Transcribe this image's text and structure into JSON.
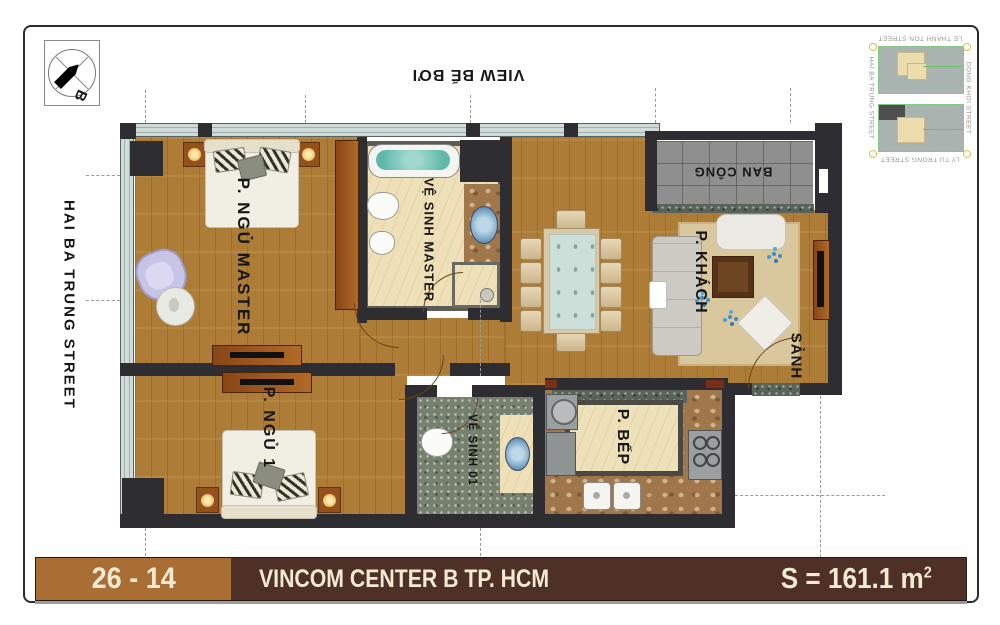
{
  "footer": {
    "unit": "26 - 14",
    "project": "VINCOM CENTER B TP. HCM",
    "area_label": "S = 161.1 m",
    "area_sup": "2"
  },
  "orientation": {
    "compass_letter": "B"
  },
  "context": {
    "top_view_label": "VIEW BỂ BƠI",
    "left_street": "HAI BA TRUNG STREET"
  },
  "rooms": {
    "master_bedroom": "P. NGỦ MASTER",
    "master_bath": "VỆ SINH MASTER",
    "bedroom1": "P. NGỦ 1",
    "bath1": "VỆ SINH 01",
    "living": "P. KHÁCH",
    "kitchen": "P. BẾP",
    "hall": "SẢNH",
    "balcony": "BAN CÔNG"
  },
  "minimap": {
    "streets": {
      "top": "LE THANH TON STREET",
      "right": "DONG KHOI STREET",
      "left": "HAI BA TRUNG STREET",
      "bottom": "LY TU TRONG STREET"
    }
  },
  "colors": {
    "footer_left": "#a86e33",
    "footer_dark": "#4e3026",
    "cream_text": "#f3ead2",
    "wood": "#ad7d37",
    "wall": "#2e2d31"
  }
}
